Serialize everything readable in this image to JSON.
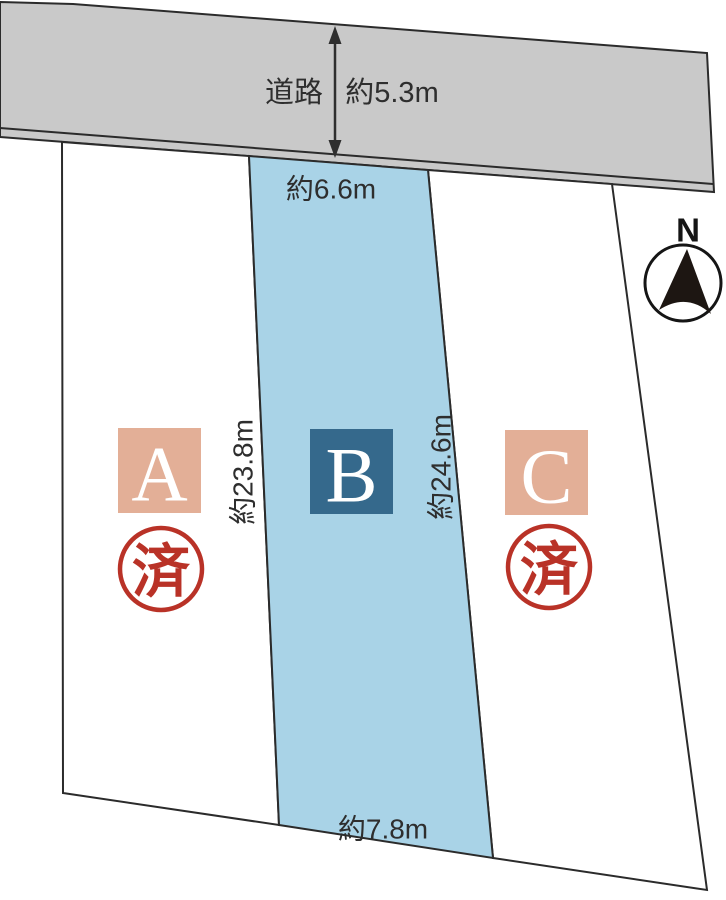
{
  "diagram": {
    "title": "land-plot-layout",
    "road": {
      "label": "道路",
      "width_label": "約5.3m"
    },
    "compass": {
      "label": "N"
    },
    "dimensions": {
      "frontage_b": "約6.6m",
      "depth_left_b": "約23.8m",
      "depth_right_b": "約24.6m",
      "rear_width_b": "約7.8m"
    },
    "plots": {
      "a": {
        "letter": "A",
        "status_stamp": "済"
      },
      "b": {
        "letter": "B"
      },
      "c": {
        "letter": "C",
        "status_stamp": "済"
      }
    },
    "colors": {
      "road_gray": "#c9c9c9",
      "plot_b_fill": "#a9d3e7",
      "plot_white": "#ffffff",
      "badge_salmon": "#e3af97",
      "badge_teal": "#35698c",
      "stamp_red": "#b93227",
      "line_dark": "#2b2b2b"
    }
  }
}
